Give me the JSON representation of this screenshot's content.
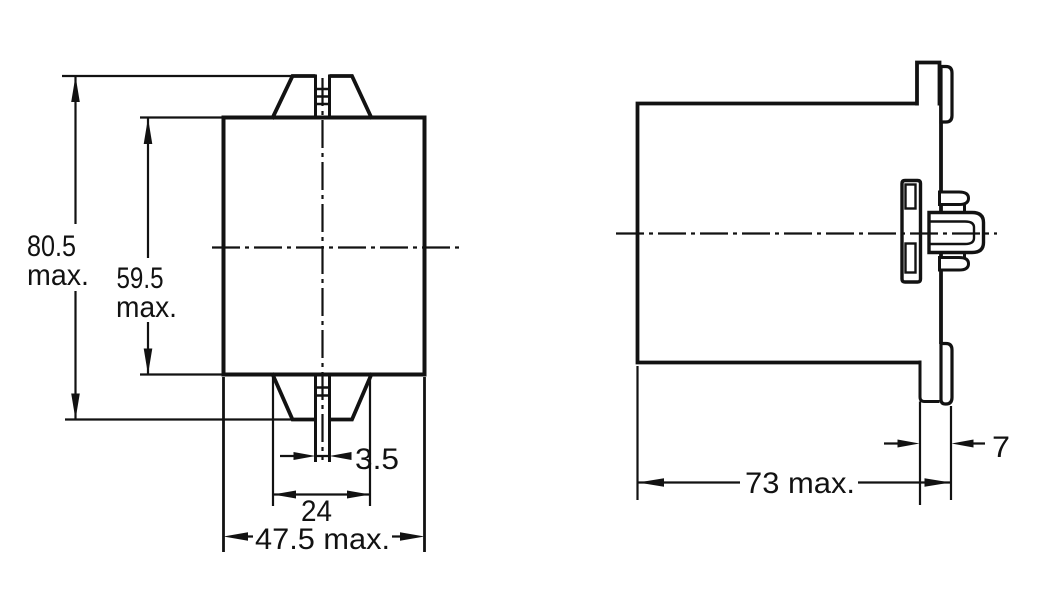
{
  "page": {
    "background": "#ffffff",
    "ink": "#121212",
    "kind": "technical-dimension-drawing"
  },
  "views": {
    "front": {
      "name": "front-view",
      "dims": {
        "total_height": {
          "value": "80.5",
          "unit_note": "max."
        },
        "case_height": {
          "value": "59.5",
          "unit_note": "max."
        },
        "screw_slot_width": {
          "value": "3.5"
        },
        "terminal_pitch": {
          "value": "24"
        },
        "case_width": {
          "value": "47.5 max."
        }
      }
    },
    "side": {
      "name": "side-view",
      "dims": {
        "depth": {
          "value": "73 max."
        },
        "flange_depth": {
          "value": "7"
        }
      }
    }
  }
}
